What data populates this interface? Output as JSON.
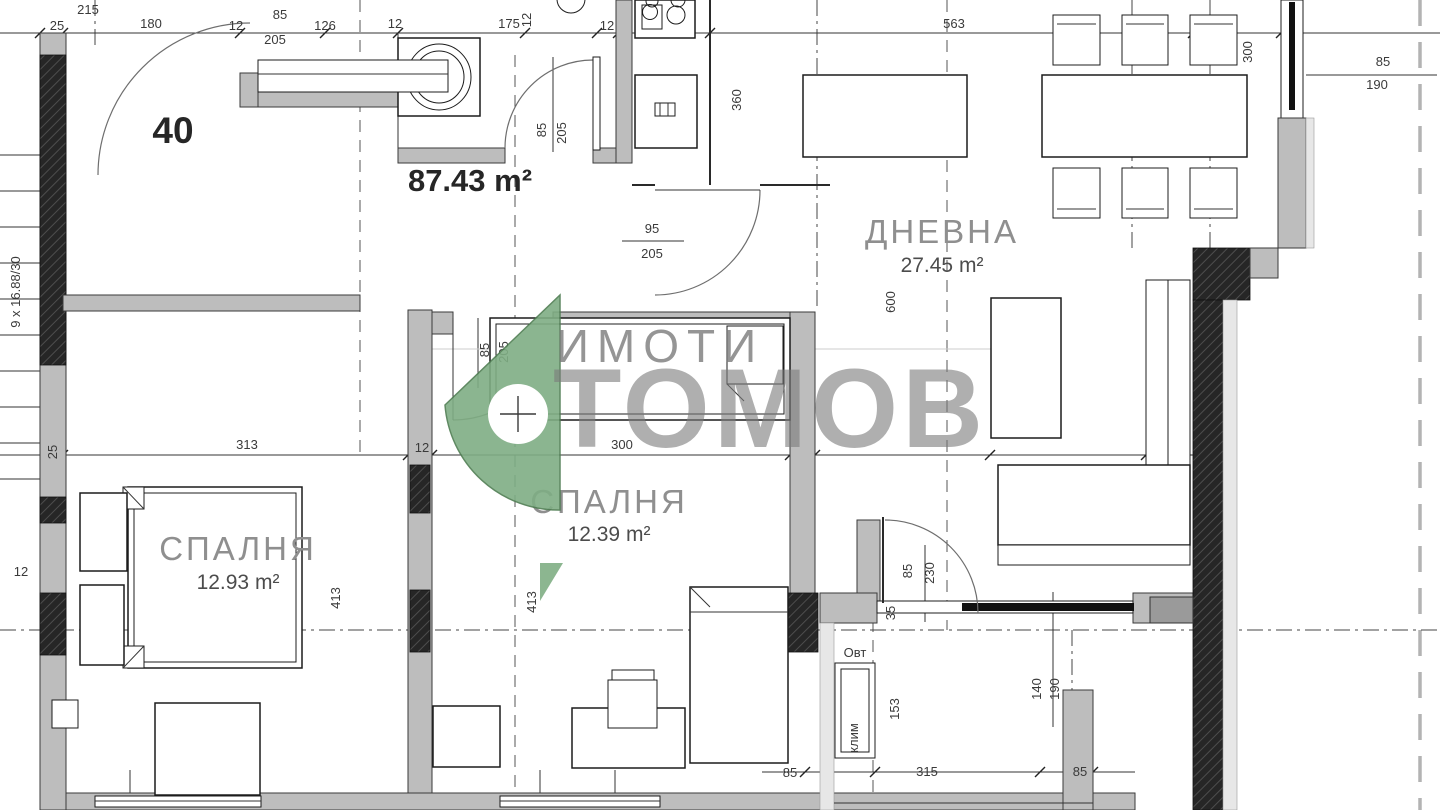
{
  "colors": {
    "logo-green": "#7fae84",
    "logo-green-dark": "#4e7d52",
    "wall-gray": "#bdbdbd",
    "line-dark": "#262626",
    "watermark-gray": "#7b7b7b",
    "dim-text": "#3a3a3a"
  },
  "plan": {
    "apartment_number": "40",
    "total_area_label": "87.43 m²",
    "stairs_label": "9 x 16.88/30",
    "watermark": {
      "top": "ИМОТИ",
      "bottom": "ТОМОВ"
    },
    "rooms": [
      {
        "name": "ДНЕВНА",
        "area": "27.45 m²",
        "x": 942,
        "name_y": 243,
        "area_y": 272
      },
      {
        "name": "СПАЛНЯ",
        "area": "12.39 m²",
        "x": 609,
        "name_y": 513,
        "area_y": 541
      },
      {
        "name": "СПАЛНЯ",
        "area": "12.93 m²",
        "x": 238,
        "name_y": 560,
        "area_y": 589
      }
    ],
    "annotations": [
      {
        "t": "215",
        "x": 88,
        "y": 14
      },
      {
        "t": "25",
        "x": 57,
        "y": 30
      },
      {
        "t": "180",
        "x": 151,
        "y": 28
      },
      {
        "t": "12",
        "x": 236,
        "y": 30
      },
      {
        "t": "85",
        "x": 280,
        "y": 19
      },
      {
        "t": "205",
        "x": 275,
        "y": 44
      },
      {
        "t": "126",
        "x": 325,
        "y": 30
      },
      {
        "t": "12",
        "x": 395,
        "y": 28
      },
      {
        "t": "175",
        "x": 509,
        "y": 28
      },
      {
        "t": "12",
        "x": 531,
        "y": 20,
        "r": 1,
        "s": 11
      },
      {
        "t": "12",
        "x": 607,
        "y": 30
      },
      {
        "t": "563",
        "x": 954,
        "y": 28
      },
      {
        "t": "300",
        "x": 1252,
        "y": 52,
        "r": 1,
        "s": 12
      },
      {
        "t": "85",
        "x": 1383,
        "y": 66
      },
      {
        "t": "190",
        "x": 1377,
        "y": 89
      },
      {
        "t": "85",
        "x": 546,
        "y": 130,
        "r": 1,
        "s": 12
      },
      {
        "t": "205",
        "x": 566,
        "y": 133,
        "r": 1,
        "s": 12
      },
      {
        "t": "360",
        "x": 741,
        "y": 100,
        "r": 1,
        "s": 12
      },
      {
        "t": "95",
        "x": 652,
        "y": 233
      },
      {
        "t": "205",
        "x": 652,
        "y": 258
      },
      {
        "t": "600",
        "x": 895,
        "y": 302,
        "r": 1,
        "s": 12
      },
      {
        "t": "85",
        "x": 489,
        "y": 350,
        "r": 1,
        "s": 12
      },
      {
        "t": "205",
        "x": 508,
        "y": 352,
        "r": 1,
        "s": 12
      },
      {
        "t": "313",
        "x": 247,
        "y": 449
      },
      {
        "t": "12",
        "x": 422,
        "y": 452
      },
      {
        "t": "300",
        "x": 622,
        "y": 449
      },
      {
        "t": "25",
        "x": 57,
        "y": 452,
        "r": 1,
        "s": 12
      },
      {
        "t": "413",
        "x": 340,
        "y": 598,
        "r": 1,
        "s": 12
      },
      {
        "t": "413",
        "x": 536,
        "y": 602,
        "r": 1,
        "s": 12
      },
      {
        "t": "12",
        "x": 21,
        "y": 576,
        "s": 12
      },
      {
        "t": "85",
        "x": 912,
        "y": 571,
        "r": 1,
        "s": 12
      },
      {
        "t": "230",
        "x": 934,
        "y": 573,
        "r": 1,
        "s": 12
      },
      {
        "t": "35",
        "x": 895,
        "y": 613,
        "r": 1,
        "s": 11
      },
      {
        "t": "153",
        "x": 899,
        "y": 709,
        "r": 1,
        "s": 11
      },
      {
        "t": "140",
        "x": 1041,
        "y": 689,
        "r": 1,
        "s": 12
      },
      {
        "t": "190",
        "x": 1059,
        "y": 689,
        "r": 1,
        "s": 12
      },
      {
        "t": "315",
        "x": 927,
        "y": 776
      },
      {
        "t": "85",
        "x": 790,
        "y": 777
      },
      {
        "t": "85",
        "x": 1080,
        "y": 776
      },
      {
        "t": "9 x 16.88/30",
        "x": 20,
        "y": 292,
        "r": 1,
        "s": 14
      },
      {
        "t": "Овт",
        "x": 855,
        "y": 657,
        "s": 12
      },
      {
        "t": "клим",
        "x": 858,
        "y": 738,
        "r": 1,
        "s": 10
      }
    ]
  }
}
